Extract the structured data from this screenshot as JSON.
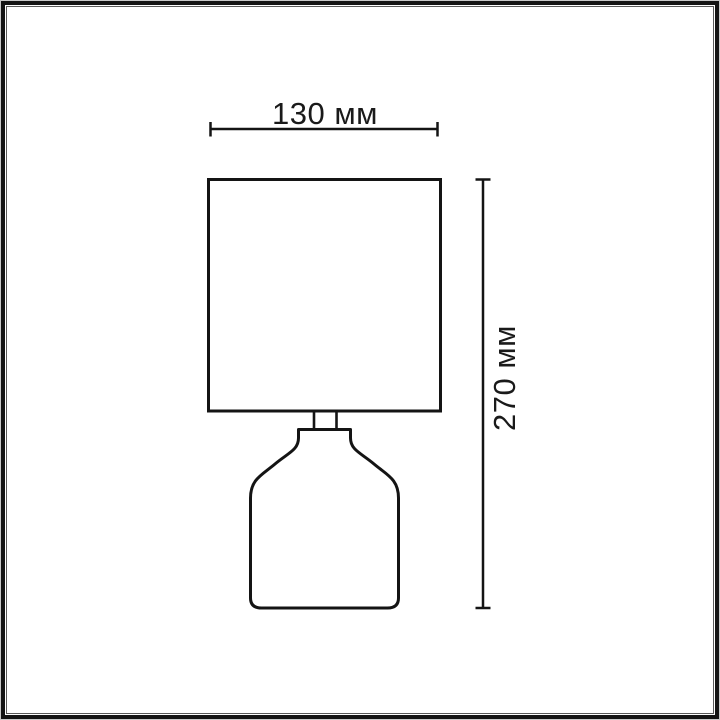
{
  "figure": {
    "subject": "table-lamp-dimension-drawing",
    "dimension_width": {
      "label": "130 мм",
      "value": 130,
      "unit": "мм"
    },
    "dimension_height": {
      "label": "270 мм",
      "value": 270,
      "unit": "мм"
    },
    "colors": {
      "line": "#141414",
      "text": "#1a1a1a",
      "background": "#ffffff",
      "frame_outer": "#c9c9c9",
      "frame_main": "#141414",
      "frame_inner": "#5a5a5a"
    }
  }
}
